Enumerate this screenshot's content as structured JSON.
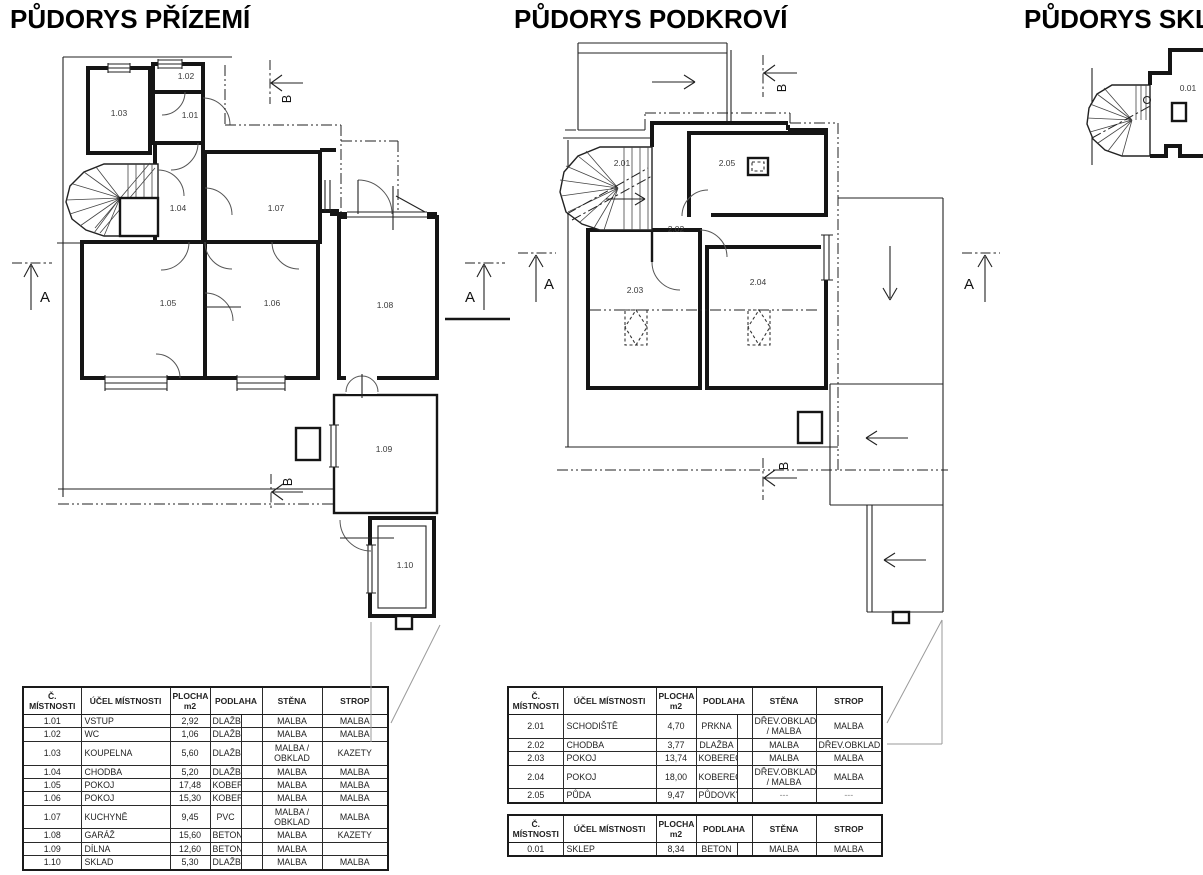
{
  "plans": {
    "ground": {
      "title": "PŮDORYS PŘÍZEMÍ",
      "room_labels": [
        "1.01",
        "1.02",
        "1.03",
        "1.04",
        "1.05",
        "1.06",
        "1.07",
        "1.08",
        "1.09",
        "1.10"
      ],
      "section_a": "A",
      "section_b": "B"
    },
    "attic": {
      "title": "PŮDORYS PODKROVÍ",
      "room_labels": [
        "2.01",
        "2.02",
        "2.03",
        "2.04",
        "2.05"
      ],
      "section_a": "A",
      "section_b": "B"
    },
    "basement": {
      "title": "PŮDORYS SKL",
      "room_labels": [
        "0.01"
      ]
    }
  },
  "tables": {
    "ground": {
      "headers": [
        "Č. MÍSTNOSTI",
        "ÚČEL MÍSTNOSTI",
        "PLOCHA\nm2",
        "PODLAHA",
        "STĚNA",
        "STROP"
      ],
      "rows": [
        [
          "1.01",
          "VSTUP",
          "2,92",
          "DLAŽBA",
          "MALBA",
          "MALBA"
        ],
        [
          "1.02",
          "WC",
          "1,06",
          "DLAŽBA",
          "MALBA",
          "MALBA"
        ],
        [
          "1.03",
          "KOUPELNA",
          "5,60",
          "DLAŽBA",
          "MALBA / OBKLAD",
          "KAZETY"
        ],
        [
          "1.04",
          "CHODBA",
          "5,20",
          "DLAŽBA",
          "MALBA",
          "MALBA"
        ],
        [
          "1.05",
          "POKOJ",
          "17,48",
          "KOBEREC",
          "MALBA",
          "MALBA"
        ],
        [
          "1.06",
          "POKOJ",
          "15,30",
          "KOBEREC",
          "MALBA",
          "MALBA"
        ],
        [
          "1.07",
          "KUCHYNĚ",
          "9,45",
          "PVC",
          "MALBA / OBKLAD",
          "MALBA"
        ],
        [
          "1.08",
          "GARÁŽ",
          "15,60",
          "BETON",
          "MALBA",
          "KAZETY"
        ],
        [
          "1.09",
          "DÍLNA",
          "12,60",
          "BETON",
          "MALBA",
          ""
        ],
        [
          "1.10",
          "SKLAD",
          "5,30",
          "DLAŽBA",
          "MALBA",
          "MALBA"
        ]
      ]
    },
    "attic": {
      "headers": [
        "Č. MÍSTNOSTI",
        "ÚČEL MÍSTNOSTI",
        "PLOCHA\nm2",
        "PODLAHA",
        "STĚNA",
        "STROP"
      ],
      "rows": [
        [
          "2.01",
          "SCHODIŠTĚ",
          "4,70",
          "PRKNA",
          "DŘEV.OBKLAD / MALBA",
          "MALBA"
        ],
        [
          "2.02",
          "CHODBA",
          "3,77",
          "DLAŽBA",
          "MALBA",
          "DŘEV.OBKLAD"
        ],
        [
          "2.03",
          "POKOJ",
          "13,74",
          "KOBEREC",
          "MALBA",
          "MALBA"
        ],
        [
          "2.04",
          "POKOJ",
          "18,00",
          "KOBEREC",
          "DŘEV.OBKLAD / MALBA",
          "MALBA"
        ],
        [
          "2.05",
          "PŮDA",
          "9,47",
          "PŮDOVKY",
          "---",
          "---"
        ]
      ]
    },
    "basement": {
      "headers": [
        "Č. MÍSTNOSTI",
        "ÚČEL MÍSTNOSTI",
        "PLOCHA\nm2",
        "PODLAHA",
        "STĚNA",
        "STROP"
      ],
      "rows": [
        [
          "0.01",
          "SKLEP",
          "8,34",
          "BETON",
          "MALBA",
          "MALBA"
        ]
      ]
    }
  }
}
